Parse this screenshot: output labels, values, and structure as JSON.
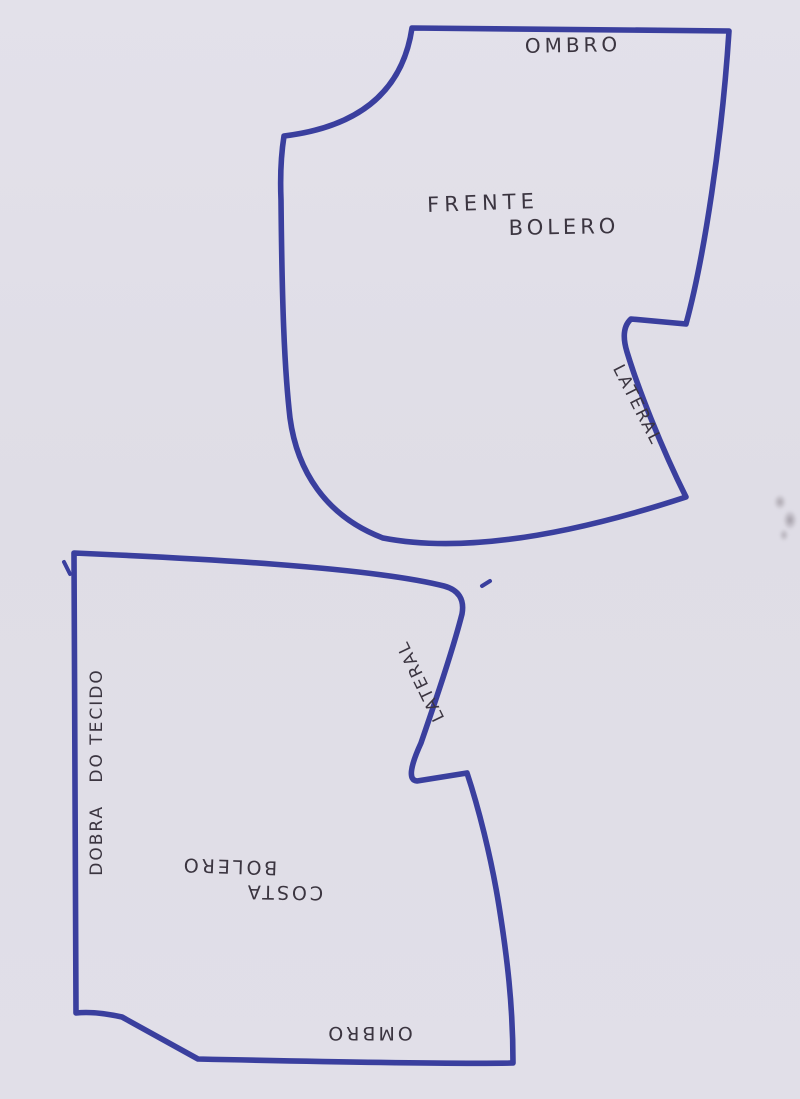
{
  "paper": {
    "background_color": "#e0dee7",
    "marker_color": "#3a3f9e",
    "pen_color": "#3b3540"
  },
  "front_piece": {
    "shoulder_label": "OMBRO",
    "name_line1": "FRENTE",
    "name_line2": "BOLERO",
    "side_label": "LATERAL"
  },
  "back_piece": {
    "fold_label": "DOBRA   DO TECIDO",
    "name_line1": "COSTA",
    "name_line2": "BOLERO",
    "side_label": "LATERAL",
    "shoulder_label": "OMBRO"
  }
}
